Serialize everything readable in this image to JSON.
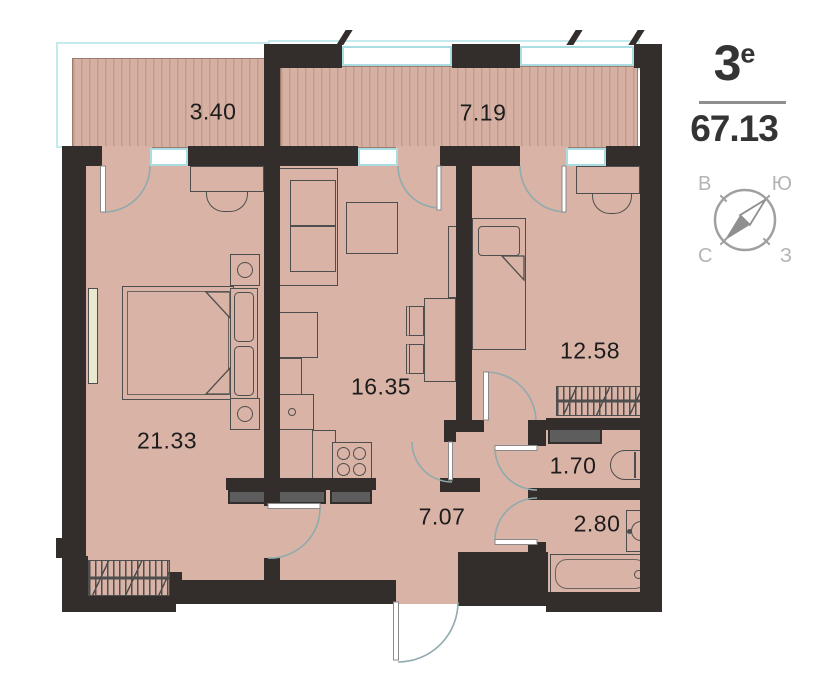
{
  "header": {
    "type_number": "3",
    "type_superscript": "е",
    "total_area": "67.13"
  },
  "compass": {
    "top_left": "В",
    "top_right": "Ю",
    "bottom_left": "С",
    "bottom_right": "З"
  },
  "rooms": [
    {
      "name": "balcony-left",
      "area": "3.40"
    },
    {
      "name": "balcony-right",
      "area": "7.19"
    },
    {
      "name": "bedroom",
      "area": "21.33"
    },
    {
      "name": "kitchen-living-room",
      "area": "16.35"
    },
    {
      "name": "bedroom-2",
      "area": "12.58"
    },
    {
      "name": "wc",
      "area": "1.70"
    },
    {
      "name": "bathroom",
      "area": "2.80"
    },
    {
      "name": "hallway",
      "area": "7.07"
    }
  ],
  "colors": {
    "wall": "#332e2c",
    "floor": "#d9b3a5",
    "balcony_stripe": "#c39b8c",
    "window_frame": "#a9dde2",
    "door_arc": "#8fabae"
  }
}
